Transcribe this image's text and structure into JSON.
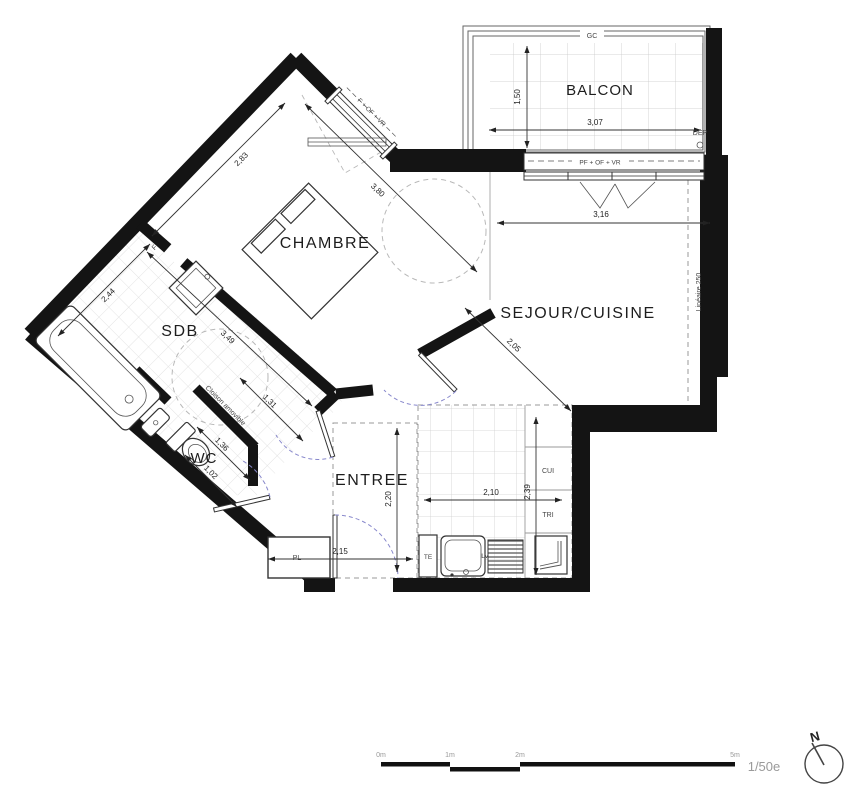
{
  "plan": {
    "rooms": {
      "balcon": "BALCON",
      "chambre": "CHAMBRE",
      "sejour": "SEJOUR/CUISINE",
      "sdb": "SDB",
      "wc": "WC",
      "entree": "ENTREE"
    },
    "annotations": {
      "gc": "GC",
      "dep": "DEP",
      "f": "F",
      "window_chambre": "F + OF + VR",
      "window_sejour": "PF + OF + VR",
      "cloison": "Cloison amovible",
      "lineaire": "Linéaire 250",
      "pl": "PL",
      "te": "TE",
      "lv": "LV",
      "cui": "CUI",
      "tri": "TRI"
    },
    "dimensions": {
      "balcon_depth": "1,50",
      "balcon_width": "3,07",
      "sejour_width": "3,16",
      "sejour_diag": "2,05",
      "chambre_nw": "2,83",
      "chambre_ne": "3,80",
      "sdb_width": "2,44",
      "sdb_length": "3,49",
      "hall": "1,31",
      "wc_width": "1,36",
      "wc_depth": "1,02",
      "entree_depth": "2,20",
      "entree_width": "2,15",
      "cuisine_width": "2,10",
      "cuisine_depth": "2,39"
    },
    "scale": {
      "ticks": [
        "0m",
        "1m",
        "2m",
        "5m"
      ],
      "ratio": "1/50e",
      "north": "N"
    },
    "colors": {
      "wall": "#141414",
      "tile": "#d8d8d8",
      "dashed_zone": "#9a9a9a",
      "door_swing": "#8888cc"
    }
  }
}
